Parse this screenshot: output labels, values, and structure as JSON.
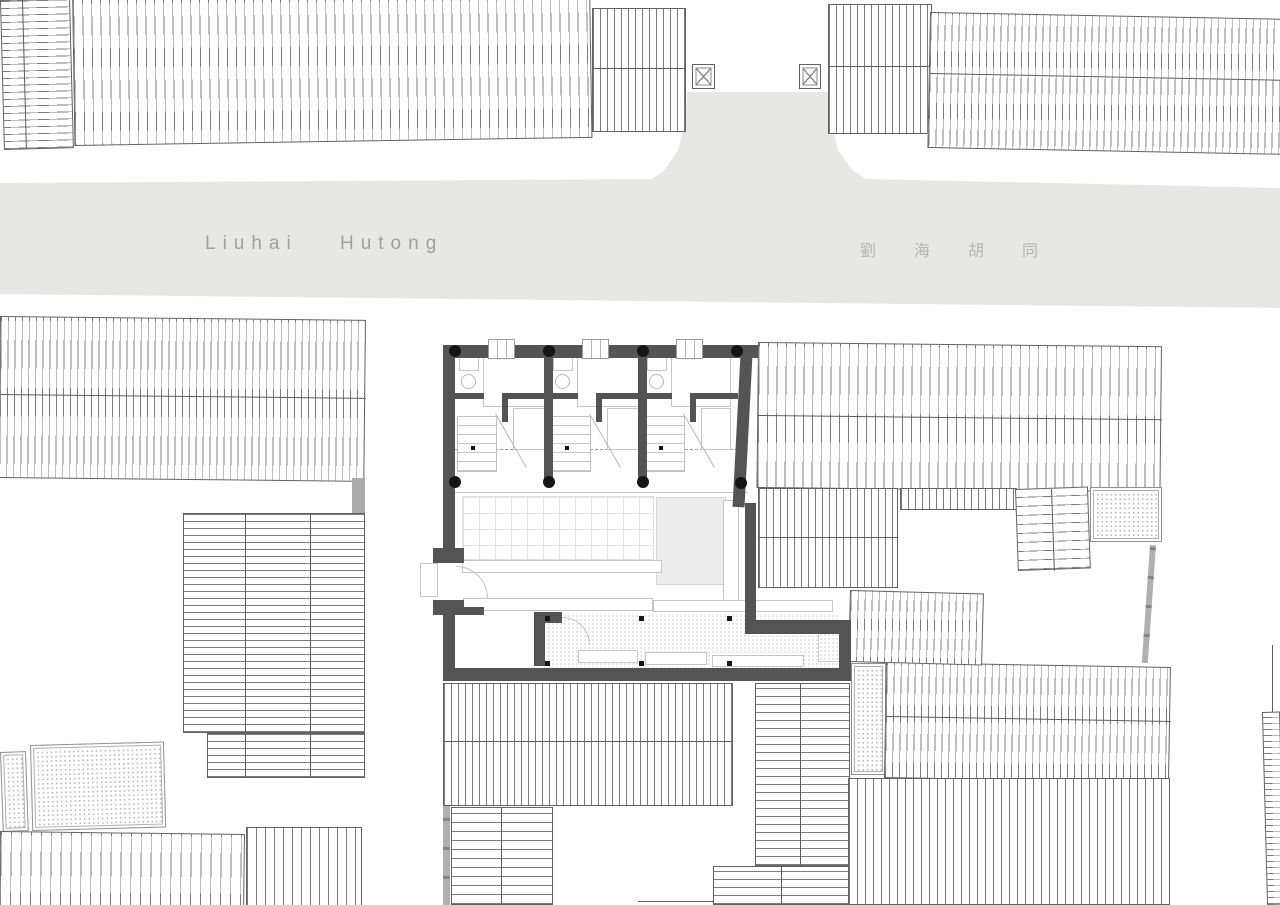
{
  "meta": {
    "title": "Liuhai Hutong site plan"
  },
  "street": {
    "label_en": "Liuhai Hutong",
    "label_zh": "劉海胡同",
    "fill": "#e7e7e6",
    "text_color_en": "#9f9f9f",
    "text_color_zh": "#b5b5b5"
  },
  "palette": {
    "background": "#ffffff",
    "street": "#e7e7e6",
    "roof_hatch_line": "#7c7c7c",
    "roof_border": "#636363",
    "plan_wall": "#545454",
    "column_black": "#141414",
    "furniture_line": "#c6c6c6",
    "floor_shade": "#ededed",
    "stipple_dot": "#b3b3b3",
    "gray_fence": "#b0b0b0"
  },
  "shapes": [
    {
      "n": "roof-northwest-small",
      "c": "hatch-h",
      "x": 0,
      "y": 0,
      "w": 70,
      "h": 150,
      "rot": -1.5,
      "sp": 7
    },
    {
      "n": "roof-northwest-small-divider",
      "c": "tlv",
      "x": 22,
      "y": 0,
      "w": 1,
      "h": 149,
      "rot": -1.5
    },
    {
      "n": "roof-north-main",
      "c": "hatch-v",
      "x": 72,
      "y": -12,
      "w": 518,
      "h": 158,
      "rot": -0.9,
      "sp": 9
    },
    {
      "n": "roof-north-small",
      "c": "hatch-v",
      "x": 592,
      "y": 8,
      "w": 94,
      "h": 124,
      "sp": 7
    },
    {
      "n": "roof-north-small-ridge",
      "c": "tlh",
      "x": 592,
      "y": 68,
      "w": 94,
      "h": 1
    },
    {
      "n": "roof-northeast-a",
      "c": "hatch-v",
      "x": 828,
      "y": 4,
      "w": 104,
      "h": 130,
      "sp": 7
    },
    {
      "n": "roof-northeast-a-ridge",
      "c": "tlh",
      "x": 828,
      "y": 66,
      "w": 104,
      "h": 1
    },
    {
      "n": "roof-northeast-main",
      "c": "hatch-v",
      "x": 930,
      "y": 12,
      "w": 354,
      "h": 136,
      "rot": 1.1,
      "sp": 7
    },
    {
      "n": "roof-northeast-main-ridge",
      "c": "tlh",
      "x": 930,
      "y": 73,
      "w": 354,
      "h": 1,
      "rot": 1.1
    },
    {
      "n": "crossed-square-marker-west",
      "c": "xbox",
      "x": 692,
      "y": 64,
      "w": 23,
      "h": 25
    },
    {
      "n": "crossed-square-marker-east",
      "c": "xbox",
      "x": 799,
      "y": 64,
      "w": 22,
      "h": 25
    },
    {
      "n": "roof-southwest-main",
      "c": "hatch-v",
      "x": 0,
      "y": 316,
      "w": 366,
      "h": 162,
      "rot": 0.6,
      "sp": 7
    },
    {
      "n": "roof-southwest-main-ridge",
      "c": "tlh",
      "x": 0,
      "y": 394,
      "w": 366,
      "h": 1,
      "rot": 0.6
    },
    {
      "n": "wall-connector-gray",
      "c": "graywall",
      "x": 352,
      "y": 478,
      "w": 13,
      "h": 35
    },
    {
      "n": "roof-southwest-stack-upper",
      "c": "hatch-h",
      "x": 183,
      "y": 513,
      "w": 182,
      "h": 220,
      "sp": 7
    },
    {
      "n": "roof-southwest-stack-lower",
      "c": "hatch-h",
      "x": 207,
      "y": 733,
      "w": 158,
      "h": 45,
      "sp": 7
    },
    {
      "n": "stack-divider-1",
      "c": "tlv",
      "x": 245,
      "y": 513,
      "w": 1,
      "h": 265
    },
    {
      "n": "stack-divider-2",
      "c": "tlv",
      "x": 310,
      "y": 513,
      "w": 1,
      "h": 265
    },
    {
      "n": "paving-southwest-small",
      "c": "stipple",
      "x": 0,
      "y": 752,
      "w": 26,
      "h": 80,
      "rot": -2
    },
    {
      "n": "paving-southwest",
      "c": "stipple",
      "x": 30,
      "y": 745,
      "w": 134,
      "h": 86,
      "rot": -1.5
    },
    {
      "n": "roof-southwest-bottom-a",
      "c": "hatch-v",
      "x": 0,
      "y": 831,
      "w": 245,
      "h": 76,
      "rot": 0.7,
      "sp": 10
    },
    {
      "n": "roof-southwest-bottom-b",
      "c": "hatch-v",
      "x": 246,
      "y": 827,
      "w": 116,
      "h": 80,
      "sp": 9
    },
    {
      "n": "roof-south-center",
      "c": "hatch-v",
      "x": 443,
      "y": 683,
      "w": 290,
      "h": 123,
      "sp": 7
    },
    {
      "n": "roof-south-center-ridge",
      "c": "tlh",
      "x": 443,
      "y": 741,
      "w": 290,
      "h": 1
    },
    {
      "n": "roof-south-center-lower",
      "c": "hatch-h",
      "x": 451,
      "y": 807,
      "w": 102,
      "h": 98,
      "sp": 9
    },
    {
      "n": "roof-south-center-lower-divider",
      "c": "tlv",
      "x": 501,
      "y": 807,
      "w": 1,
      "h": 98
    },
    {
      "n": "wall-south-gray-strip",
      "c": "fence-v",
      "x": 443,
      "y": 806,
      "w": 7,
      "h": 99
    },
    {
      "n": "roof-south-step-a",
      "c": "hatch-h",
      "x": 755,
      "y": 683,
      "w": 95,
      "h": 183,
      "sp": 8
    },
    {
      "n": "roof-south-step-a-divider",
      "c": "tlv",
      "x": 800,
      "y": 683,
      "w": 1,
      "h": 183
    },
    {
      "n": "roof-south-step-b",
      "c": "hatch-h",
      "x": 713,
      "y": 866,
      "w": 137,
      "h": 39,
      "sp": 8
    },
    {
      "n": "roof-south-step-b-divider",
      "c": "tlv",
      "x": 781,
      "y": 866,
      "w": 1,
      "h": 39
    },
    {
      "n": "roof-south-step-c-edge",
      "c": "tlh",
      "x": 638,
      "y": 901,
      "w": 76,
      "h": 1
    },
    {
      "n": "paving-southeast",
      "c": "stipple",
      "x": 851,
      "y": 663,
      "w": 35,
      "h": 112
    },
    {
      "n": "roof-southeast-upper",
      "c": "hatch-v",
      "x": 886,
      "y": 662,
      "w": 285,
      "h": 116,
      "rot": 1,
      "sp": 7
    },
    {
      "n": "roof-southeast-upper-ridge",
      "c": "tlh",
      "x": 886,
      "y": 716,
      "w": 285,
      "h": 1,
      "rot": 1
    },
    {
      "n": "roof-southeast-lower",
      "c": "hatch-v",
      "x": 848,
      "y": 778,
      "w": 322,
      "h": 127,
      "sp": 8
    },
    {
      "n": "roof-east-edge-sliver",
      "c": "hatch-h",
      "x": 1262,
      "y": 712,
      "w": 18,
      "h": 193,
      "rot": -1.5,
      "sp": 6
    },
    {
      "n": "wall-east-edge-line",
      "c": "tlv",
      "x": 1272,
      "y": 645,
      "w": 1,
      "h": 67
    },
    {
      "n": "roof-east-main",
      "c": "hatch-v",
      "x": 758,
      "y": 342,
      "w": 404,
      "h": 146,
      "rot": 0.6,
      "sp": 9
    },
    {
      "n": "roof-east-main-ridge",
      "c": "tlh",
      "x": 758,
      "y": 415,
      "w": 404,
      "h": 1,
      "rot": 0.6
    },
    {
      "n": "roof-east-band",
      "c": "hatch-v",
      "x": 758,
      "y": 488,
      "w": 140,
      "h": 100,
      "sp": 7
    },
    {
      "n": "roof-east-band-ridge",
      "c": "tlh",
      "x": 758,
      "y": 537,
      "w": 140,
      "h": 1
    },
    {
      "n": "roof-east-strip",
      "c": "hatch-v",
      "x": 900,
      "y": 488,
      "w": 117,
      "h": 22,
      "sp": 7
    },
    {
      "n": "stairs-east",
      "c": "hatch-h",
      "x": 1015,
      "y": 489,
      "w": 73,
      "h": 82,
      "rot": -2,
      "sp": 9
    },
    {
      "n": "stairs-east-divider",
      "c": "tlv",
      "x": 1051,
      "y": 489,
      "w": 1,
      "h": 82,
      "rot": -2
    },
    {
      "n": "paving-east",
      "c": "stipple",
      "x": 1090,
      "y": 487,
      "w": 72,
      "h": 55
    },
    {
      "n": "fence-east",
      "c": "fence-v",
      "x": 1150,
      "y": 545,
      "w": 6,
      "h": 118,
      "rot": 4
    },
    {
      "n": "roof-east-lower",
      "c": "hatch-v",
      "x": 850,
      "y": 590,
      "w": 134,
      "h": 72,
      "rot": 1.5,
      "sp": 7
    },
    {
      "n": "floor-grid",
      "c": "grid",
      "x": 462,
      "y": 496,
      "w": 192,
      "h": 64
    },
    {
      "n": "floor-shade",
      "c": "shade",
      "x": 656,
      "y": 497,
      "w": 70,
      "h": 88
    },
    {
      "n": "shelf-wall-east",
      "c": "light",
      "x": 723,
      "y": 500,
      "w": 16,
      "h": 110
    },
    {
      "n": "counter-a",
      "c": "light",
      "x": 462,
      "y": 560,
      "w": 200,
      "h": 13
    },
    {
      "n": "counter-b",
      "c": "light",
      "x": 463,
      "y": 598,
      "w": 190,
      "h": 13
    },
    {
      "n": "counter-c",
      "c": "light",
      "x": 653,
      "y": 600,
      "w": 180,
      "h": 12
    },
    {
      "n": "terrace-dots",
      "c": "dots-floor",
      "x": 543,
      "y": 614,
      "w": 296,
      "h": 54
    },
    {
      "n": "corner-paving",
      "c": "dotbox",
      "x": 818,
      "y": 628,
      "w": 25,
      "h": 34
    },
    {
      "n": "bench-1",
      "c": "light",
      "x": 578,
      "y": 650,
      "w": 60,
      "h": 13
    },
    {
      "n": "bench-2",
      "c": "light",
      "x": 645,
      "y": 652,
      "w": 62,
      "h": 13
    },
    {
      "n": "bench-3",
      "c": "light",
      "x": 712,
      "y": 655,
      "w": 92,
      "h": 12
    },
    {
      "n": "entry-canopy",
      "c": "light",
      "x": 420,
      "y": 563,
      "w": 18,
      "h": 34
    },
    {
      "n": "door-arc-entrance",
      "c": "arc",
      "x": 456,
      "y": 566,
      "w": 32,
      "h": 32
    },
    {
      "n": "door-arc-courtyard",
      "c": "arc",
      "x": 562,
      "y": 617,
      "w": 28,
      "h": 28
    },
    {
      "n": "guide-dashed-line",
      "c": "dash-h",
      "x": 455,
      "y": 449,
      "w": 293,
      "h": 1
    },
    {
      "n": "veranda-line",
      "c": "tlh-light",
      "x": 455,
      "y": 492,
      "w": 293,
      "h": 1
    },
    {
      "n": "bath-counter-unit1",
      "c": "light",
      "x": 459,
      "y": 357,
      "w": 20,
      "h": 14
    },
    {
      "n": "bath-counter-unit2",
      "c": "light",
      "x": 553,
      "y": 357,
      "w": 20,
      "h": 14
    },
    {
      "n": "bath-counter-unit3",
      "c": "light",
      "x": 647,
      "y": 357,
      "w": 20,
      "h": 14
    },
    {
      "n": "basin-unit1",
      "c": "circle-light",
      "x": 461,
      "y": 374,
      "w": 15,
      "h": 15
    },
    {
      "n": "basin-unit2",
      "c": "circle-light",
      "x": 555,
      "y": 374,
      "w": 15,
      "h": 15
    },
    {
      "n": "basin-unit3",
      "c": "circle-light",
      "x": 649,
      "y": 374,
      "w": 15,
      "h": 15
    },
    {
      "n": "bed-unit1",
      "c": "light",
      "x": 483,
      "y": 357,
      "w": 62,
      "h": 50
    },
    {
      "n": "bed-unit2",
      "c": "light",
      "x": 577,
      "y": 357,
      "w": 62,
      "h": 50
    },
    {
      "n": "bed-unit3",
      "c": "light",
      "x": 671,
      "y": 357,
      "w": 60,
      "h": 50
    },
    {
      "n": "cabinet-unit1",
      "c": "light",
      "x": 513,
      "y": 408,
      "w": 32,
      "h": 42
    },
    {
      "n": "cabinet-unit2",
      "c": "light",
      "x": 607,
      "y": 408,
      "w": 32,
      "h": 42
    },
    {
      "n": "cabinet-unit3",
      "c": "light",
      "x": 701,
      "y": 408,
      "w": 30,
      "h": 42
    },
    {
      "n": "stairs-unit1",
      "c": "stairbox",
      "x": 457,
      "y": 416,
      "w": 40,
      "h": 56
    },
    {
      "n": "stairs-unit2",
      "c": "stairbox",
      "x": 551,
      "y": 416,
      "w": 40,
      "h": 56
    },
    {
      "n": "stairs-unit3",
      "c": "stairbox",
      "x": 645,
      "y": 416,
      "w": 40,
      "h": 56
    },
    {
      "n": "stairs-cut-unit1",
      "c": "diagl",
      "x": 495,
      "y": 414,
      "w": 1,
      "h": 62,
      "rot": -30
    },
    {
      "n": "stairs-cut-unit2",
      "c": "diagl",
      "x": 589,
      "y": 414,
      "w": 1,
      "h": 62,
      "rot": -30
    },
    {
      "n": "stairs-cut-unit3",
      "c": "diagl",
      "x": 683,
      "y": 414,
      "w": 1,
      "h": 62,
      "rot": -30
    },
    {
      "n": "post-dot-unit1",
      "c": "dot",
      "x": 471,
      "y": 446,
      "w": 4,
      "h": 4
    },
    {
      "n": "post-dot-unit2",
      "c": "dot",
      "x": 565,
      "y": 446,
      "w": 4,
      "h": 4
    },
    {
      "n": "post-dot-unit3",
      "c": "dot",
      "x": 659,
      "y": 446,
      "w": 4,
      "h": 4
    },
    {
      "n": "wall-top",
      "c": "wall",
      "x": 443,
      "y": 345,
      "w": 315,
      "h": 13
    },
    {
      "n": "wall-left-upper",
      "c": "wall",
      "x": 443,
      "y": 345,
      "w": 12,
      "h": 205
    },
    {
      "n": "wall-door-flange-upper",
      "c": "wall",
      "x": 433,
      "y": 548,
      "w": 31,
      "h": 15
    },
    {
      "n": "wall-door-flange-lower",
      "c": "wall",
      "x": 433,
      "y": 600,
      "w": 31,
      "h": 15
    },
    {
      "n": "wall-left-lower",
      "c": "wall",
      "x": 443,
      "y": 600,
      "w": 12,
      "h": 81
    },
    {
      "n": "wall-nub",
      "c": "wall",
      "x": 464,
      "y": 607,
      "w": 20,
      "h": 8
    },
    {
      "n": "wall-right-slant",
      "c": "wall",
      "x": 741,
      "y": 345,
      "w": 12,
      "h": 162,
      "rot": 3
    },
    {
      "n": "wall-right-lower",
      "c": "wall",
      "x": 745,
      "y": 503,
      "w": 11,
      "h": 122
    },
    {
      "n": "wall-bottom-east",
      "c": "wall",
      "x": 745,
      "y": 620,
      "w": 106,
      "h": 14
    },
    {
      "n": "wall-southeast-vertical",
      "c": "wall",
      "x": 839,
      "y": 620,
      "w": 12,
      "h": 61
    },
    {
      "n": "wall-bottom",
      "c": "wall",
      "x": 443,
      "y": 668,
      "w": 408,
      "h": 13
    },
    {
      "n": "wall-L-horizontal",
      "c": "wall",
      "x": 534,
      "y": 612,
      "w": 28,
      "h": 11
    },
    {
      "n": "wall-L-vertical",
      "c": "wall",
      "x": 534,
      "y": 612,
      "w": 11,
      "h": 54
    },
    {
      "n": "partition-1",
      "c": "wall",
      "x": 544,
      "y": 356,
      "w": 9,
      "h": 128
    },
    {
      "n": "partition-2",
      "c": "wall",
      "x": 638,
      "y": 356,
      "w": 9,
      "h": 128
    },
    {
      "n": "bath-wall-left-unit1",
      "c": "wall",
      "x": 454,
      "y": 393,
      "w": 30,
      "h": 6
    },
    {
      "n": "bath-wall-right-unit1",
      "c": "wall",
      "x": 502,
      "y": 393,
      "w": 47,
      "h": 6
    },
    {
      "n": "bath-wall-return-unit1",
      "c": "wall",
      "x": 502,
      "y": 399,
      "w": 6,
      "h": 23
    },
    {
      "n": "bath-wall-left-unit2",
      "c": "wall",
      "x": 548,
      "y": 393,
      "w": 30,
      "h": 6
    },
    {
      "n": "bath-wall-right-unit2",
      "c": "wall",
      "x": 596,
      "y": 393,
      "w": 47,
      "h": 6
    },
    {
      "n": "bath-wall-return-unit2",
      "c": "wall",
      "x": 596,
      "y": 399,
      "w": 6,
      "h": 23
    },
    {
      "n": "bath-wall-left-unit3",
      "c": "wall",
      "x": 642,
      "y": 393,
      "w": 30,
      "h": 6
    },
    {
      "n": "bath-wall-right-unit3",
      "c": "wall",
      "x": 690,
      "y": 393,
      "w": 48,
      "h": 6
    },
    {
      "n": "bath-wall-return-unit3",
      "c": "wall",
      "x": 690,
      "y": 399,
      "w": 6,
      "h": 23
    },
    {
      "n": "window-unit1",
      "c": "window",
      "x": 488,
      "y": 339,
      "w": 27,
      "h": 20
    },
    {
      "n": "window-unit2",
      "c": "window",
      "x": 582,
      "y": 339,
      "w": 27,
      "h": 20
    },
    {
      "n": "window-unit3",
      "c": "window",
      "x": 676,
      "y": 339,
      "w": 27,
      "h": 20
    },
    {
      "n": "column-top-1",
      "c": "column",
      "x": 449,
      "y": 345,
      "w": 12,
      "h": 12
    },
    {
      "n": "column-top-2",
      "c": "column",
      "x": 543,
      "y": 345,
      "w": 12,
      "h": 12
    },
    {
      "n": "column-top-3",
      "c": "column",
      "x": 637,
      "y": 345,
      "w": 12,
      "h": 12
    },
    {
      "n": "column-top-4",
      "c": "column",
      "x": 731,
      "y": 345,
      "w": 12,
      "h": 12
    },
    {
      "n": "column-mid-1",
      "c": "column",
      "x": 449,
      "y": 476,
      "w": 12,
      "h": 12
    },
    {
      "n": "column-mid-2",
      "c": "column",
      "x": 543,
      "y": 476,
      "w": 12,
      "h": 12
    },
    {
      "n": "column-mid-3",
      "c": "column",
      "x": 637,
      "y": 476,
      "w": 12,
      "h": 12
    },
    {
      "n": "column-mid-4",
      "c": "column",
      "x": 735,
      "y": 477,
      "w": 12,
      "h": 12
    },
    {
      "n": "terrace-post-1",
      "c": "dot",
      "x": 545,
      "y": 616,
      "w": 5,
      "h": 5
    },
    {
      "n": "terrace-post-2",
      "c": "dot",
      "x": 639,
      "y": 616,
      "w": 5,
      "h": 5
    },
    {
      "n": "terrace-post-3",
      "c": "dot",
      "x": 727,
      "y": 616,
      "w": 5,
      "h": 5
    },
    {
      "n": "terrace-post-4",
      "c": "dot",
      "x": 545,
      "y": 661,
      "w": 5,
      "h": 5
    },
    {
      "n": "terrace-post-5",
      "c": "dot",
      "x": 639,
      "y": 661,
      "w": 5,
      "h": 5
    },
    {
      "n": "terrace-post-6",
      "c": "dot",
      "x": 727,
      "y": 661,
      "w": 5,
      "h": 5
    }
  ]
}
